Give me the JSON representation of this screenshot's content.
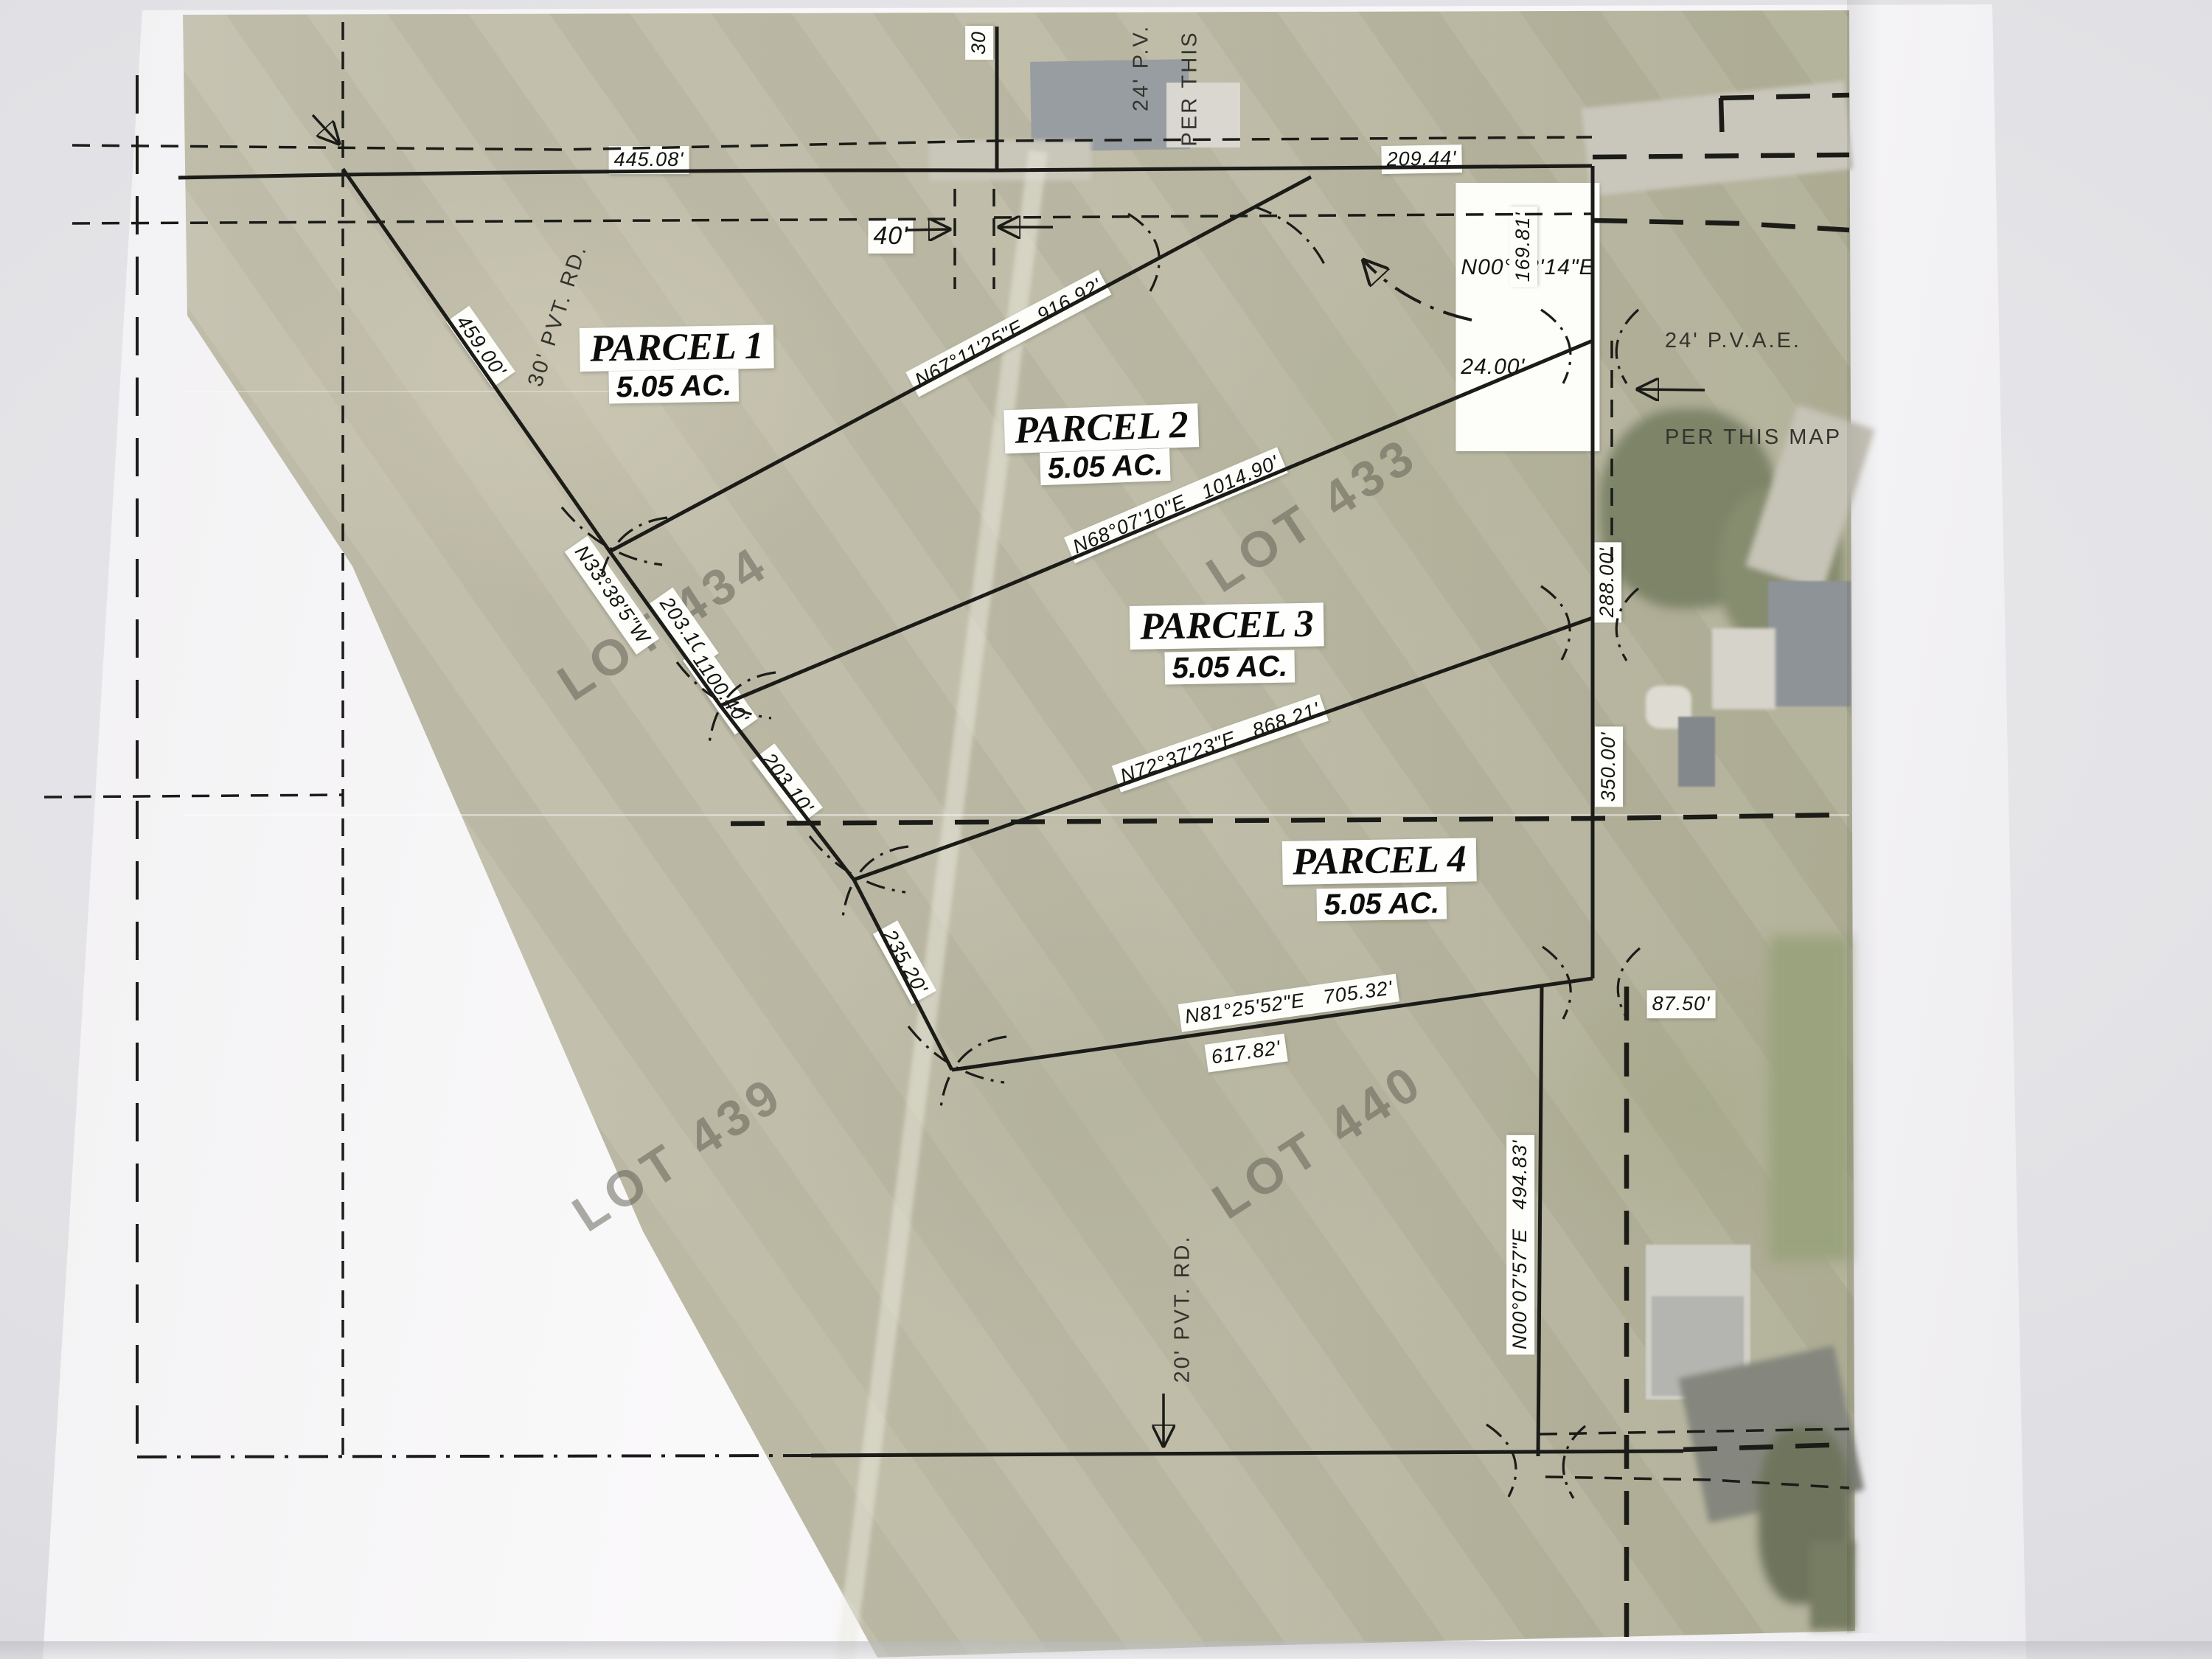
{
  "map": {
    "parcels": [
      {
        "name": "PARCEL 1",
        "area": "5.05 AC."
      },
      {
        "name": "PARCEL 2",
        "area": "5.05 AC."
      },
      {
        "name": "PARCEL 3",
        "area": "5.05 AC."
      },
      {
        "name": "PARCEL 4",
        "area": "5.05 AC."
      }
    ],
    "lots": [
      "LOT 433",
      "LOT 434",
      "LOT 439",
      "LOT 440"
    ],
    "labels": {
      "d445": "445.08'",
      "d209": "209.44'",
      "n008a": "N00°08'14\"E",
      "n008b": "24.00'",
      "d169": "169.81'",
      "pv24a": "24' P.V.",
      "pv24b": "PER THIS",
      "d30": "30",
      "d40": "40'",
      "road30": "30' PVT. RD.",
      "d459": "459.00'",
      "n67": "N67°11'25\"E   916.92'",
      "n68": "N68°07'10\"E   1014.90'",
      "n33": "N33°38'5\"W",
      "d203a": "203.10'",
      "d1100": "1100.40'",
      "d203b": "203.10'",
      "d235": "235.20'",
      "n72": "N72°37'23\"E   868.21'",
      "d288": "288.00'",
      "d350": "350.00'",
      "pvae_l1": "24' P.V.A.E.",
      "pvae_l2": "PER THIS MAP",
      "n81": "N81°25'52\"E   705.32'",
      "d617": "617.82'",
      "d87": "87.50'",
      "n007": "N00°07'57\"E   494.83'",
      "road20": "20' PVT. RD."
    },
    "palette": {
      "paper": "#f6f5f7",
      "aerial_base": "#bcbaa5",
      "line_ink": "#1b1b18",
      "label_bg": "#fdfdfa"
    }
  }
}
